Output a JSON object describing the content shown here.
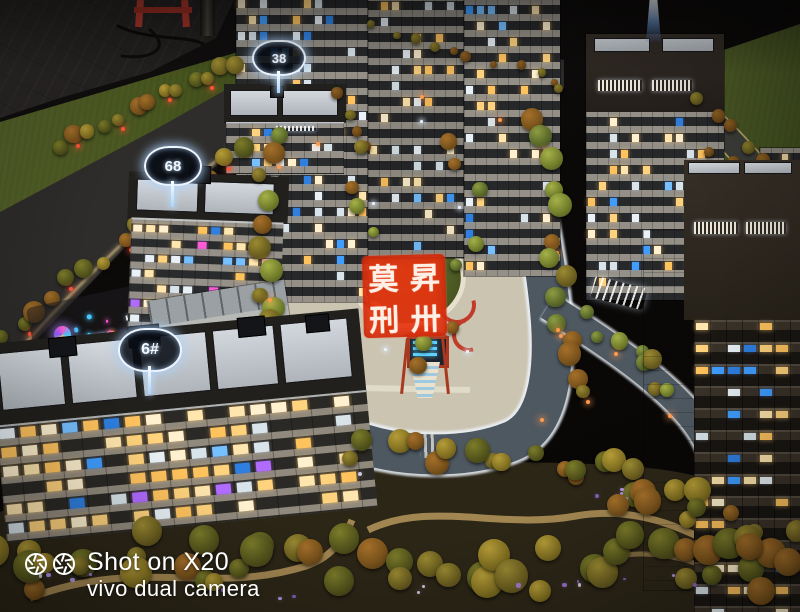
{
  "watermark": {
    "line1": "Shot on X20",
    "line2": "vivo dual camera"
  },
  "signs": {
    "tower38": "38",
    "tower68": "68",
    "building6": "6#"
  },
  "seal": {
    "top_left": "莫",
    "top_right": "昇",
    "bottom_left": "刑",
    "bottom_right": "卅"
  },
  "colors": {
    "seal_red": "#e63410",
    "sign_glow": "#cfe4ff",
    "lamp_red": "#ff5336",
    "lamp_amber": "#ff9a4e",
    "road_asphalt": "#4e5861",
    "plaza_paving": "#cbc4b1",
    "lawn_green": "#4f5d26"
  }
}
